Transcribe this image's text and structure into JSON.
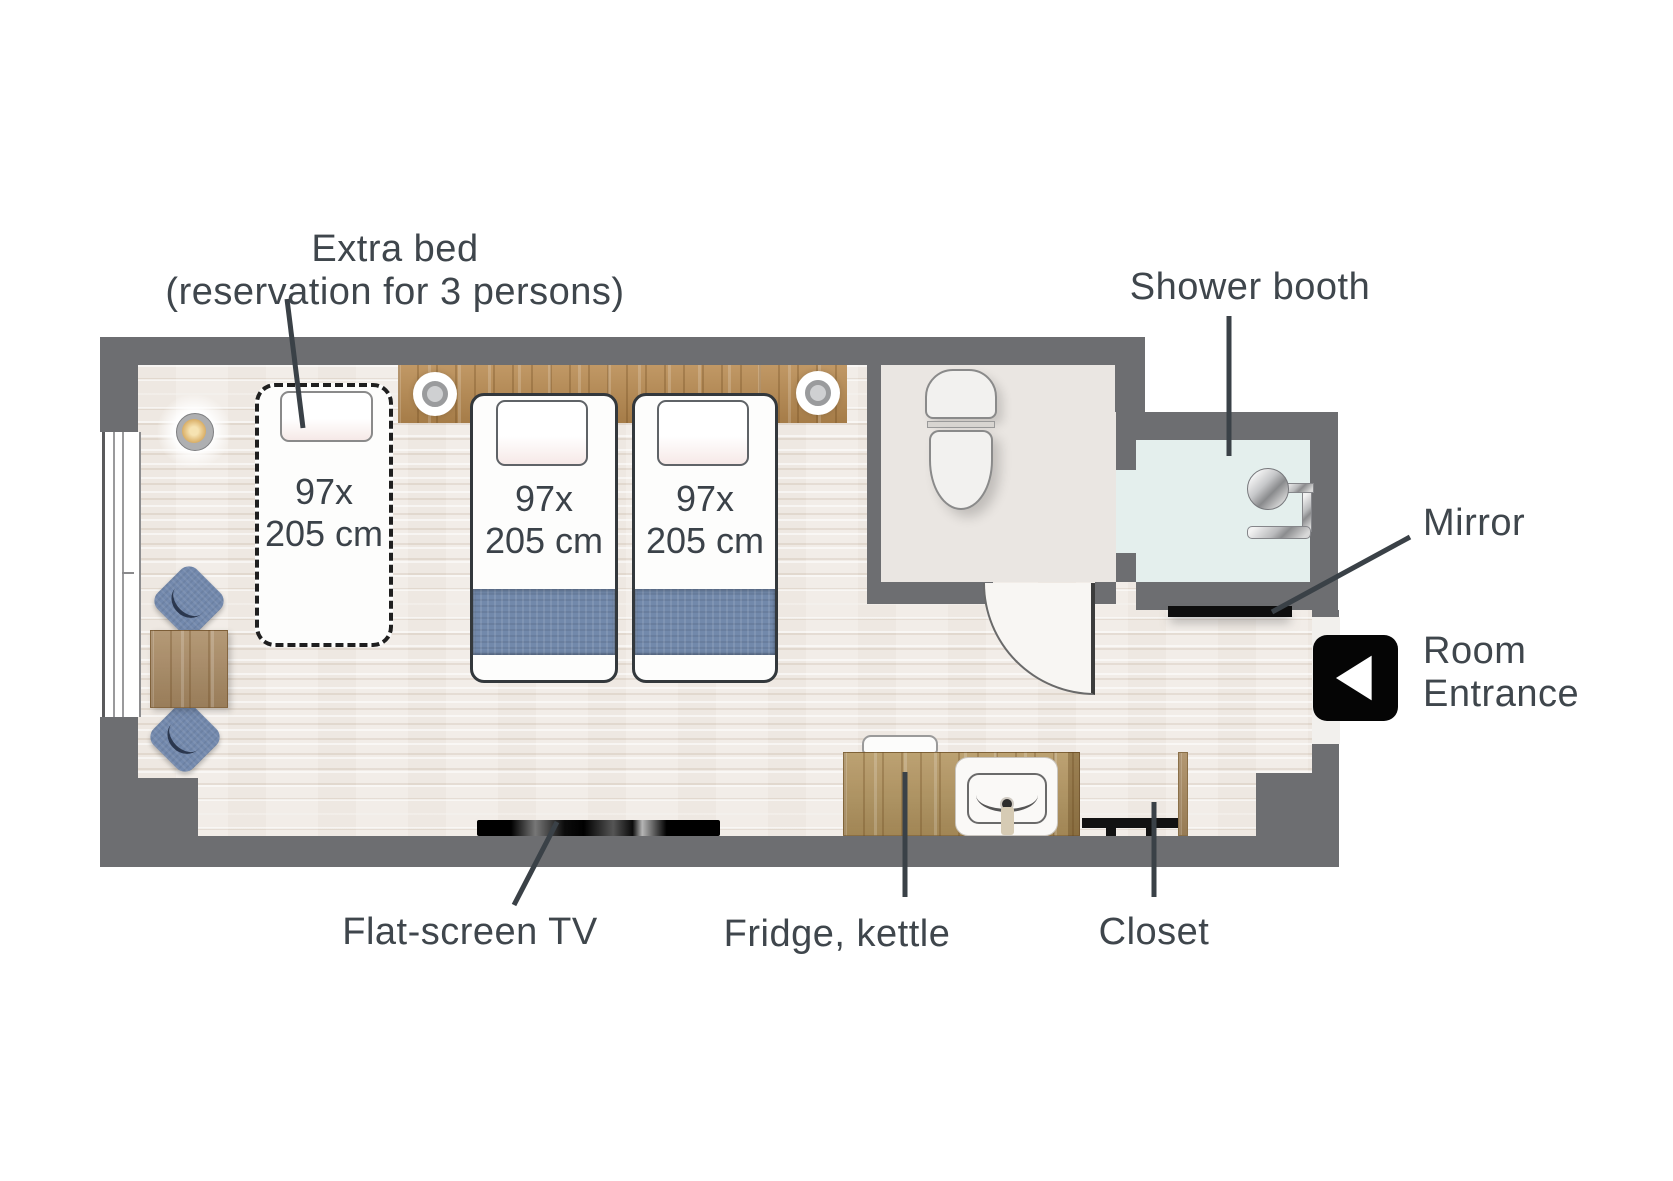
{
  "title": "Hotel room floor plan",
  "labels": {
    "extra_bed_line1": "Extra bed",
    "extra_bed_line2": "(reservation for 3 persons)",
    "shower_booth": "Shower booth",
    "mirror": "Mirror",
    "room_entrance_line1": "Room",
    "room_entrance_line2": "Entrance",
    "flat_screen_tv": "Flat-screen TV",
    "fridge_kettle": "Fridge, kettle",
    "closet": "Closet"
  },
  "beds": {
    "extra": {
      "size_line1": "97x",
      "size_line2": "205 cm"
    },
    "twin_left": {
      "size_line1": "97x",
      "size_line2": "205 cm"
    },
    "twin_right": {
      "size_line1": "97x",
      "size_line2": "205 cm"
    }
  },
  "colors": {
    "wall": "#6d6e71",
    "bedroom_floor": "#f2ede8",
    "bathroom_floor": "#eae6e2",
    "shower_booth_floor": "#e4efed",
    "wood": "#b3925f",
    "blanket_blue": "#7289ab",
    "chair_blue": "#7389ad",
    "label_text": "#3f464c",
    "leader_line": "#3a4147",
    "mirror_black": "#0e0e0e",
    "tv_black": "#000000",
    "entrance_marker": "#050505"
  }
}
